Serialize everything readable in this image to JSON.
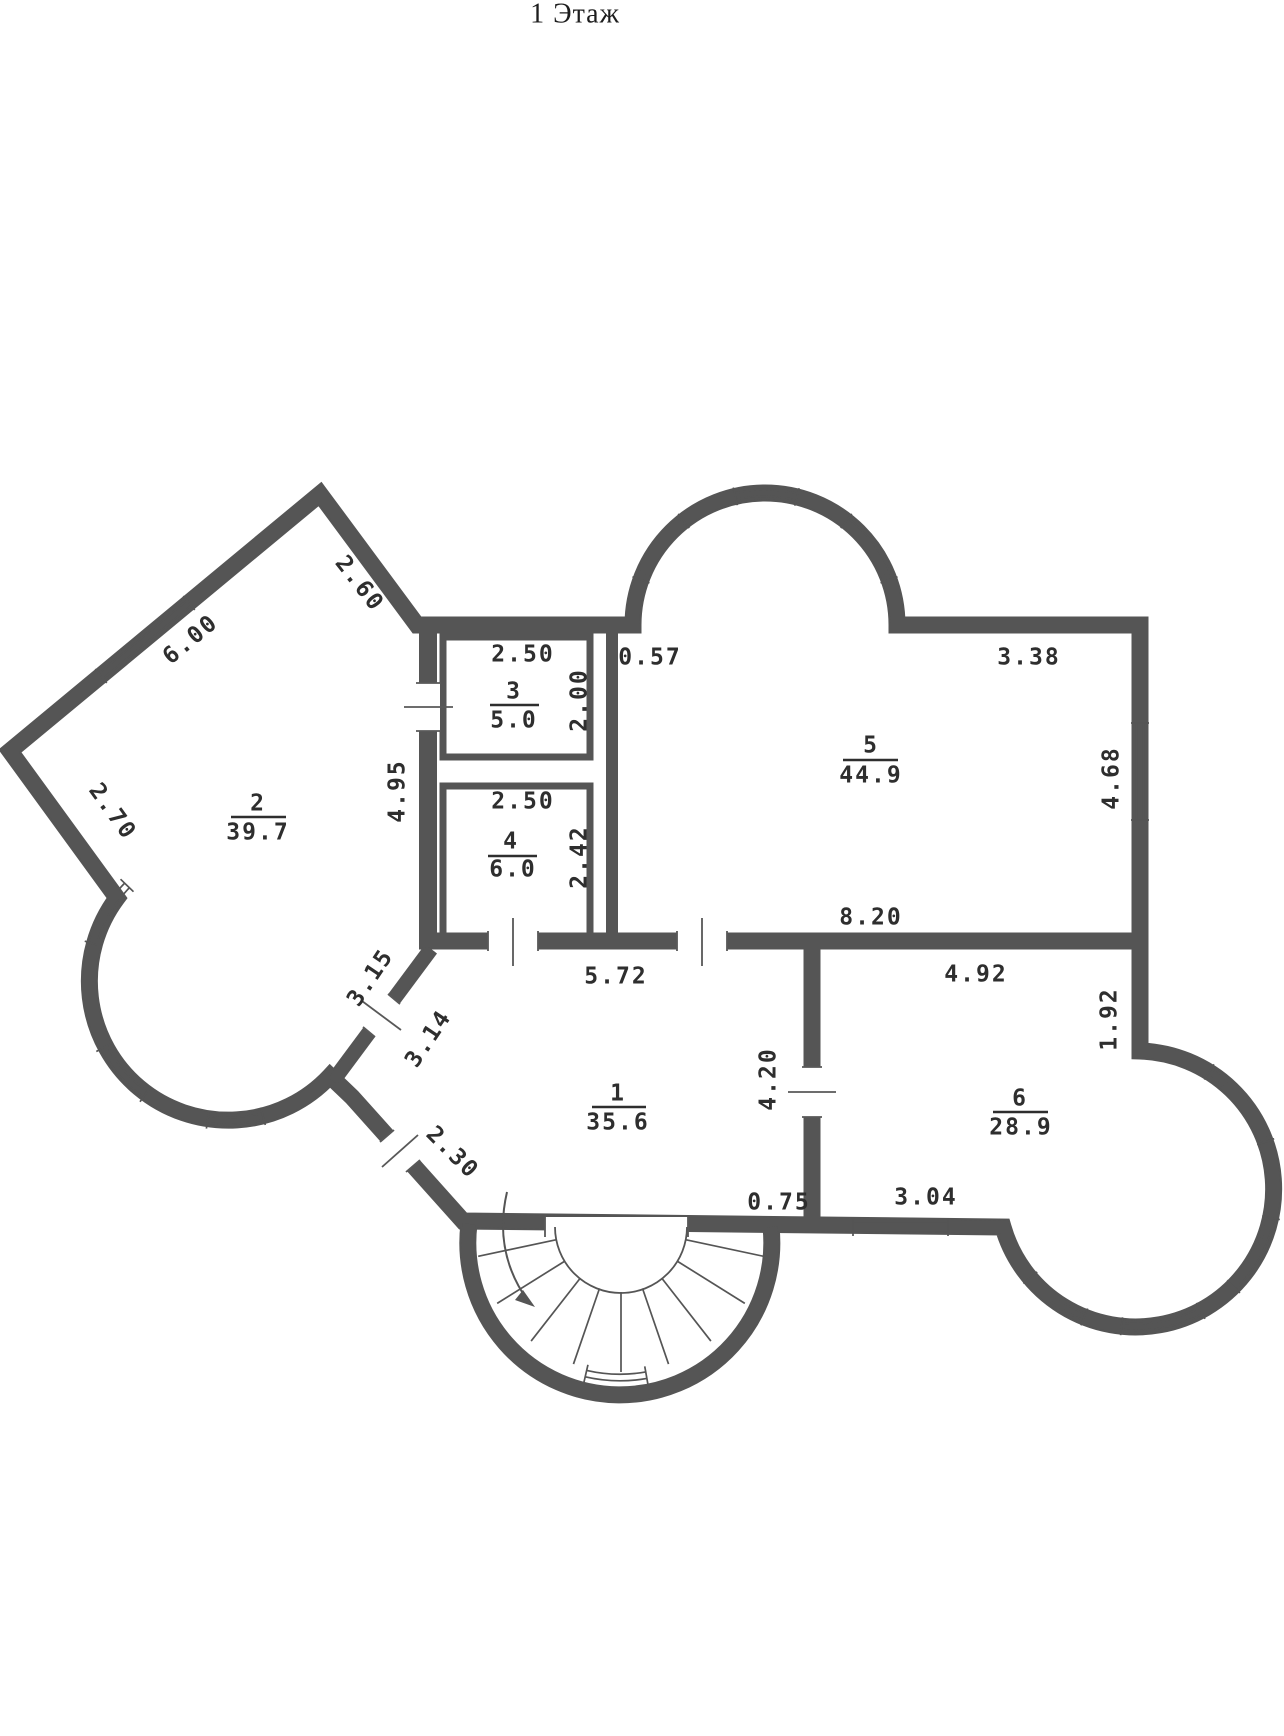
{
  "title": "1 Этаж",
  "floor_plan": {
    "rooms": [
      {
        "number": "1",
        "area": "35.6"
      },
      {
        "number": "2",
        "area": "39.7"
      },
      {
        "number": "3",
        "area": "5.0"
      },
      {
        "number": "4",
        "area": "6.0"
      },
      {
        "number": "5",
        "area": "44.9"
      },
      {
        "number": "6",
        "area": "28.9"
      }
    ],
    "dimensions": {
      "top_left_wall": "2.60",
      "upper_left_wall": "6.00",
      "left_wall": "2.70",
      "room2_right_wall": "4.95",
      "room3_width": "2.50",
      "room3_height": "2.00",
      "room5_top_left": "0.57",
      "room5_top_right": "3.38",
      "room5_right_wall": "4.68",
      "room4_width": "2.50",
      "room4_height": "2.42",
      "room5_bottom": "8.20",
      "room1_top": "5.72",
      "room6_top": "4.92",
      "room6_right_wall": "1.92",
      "room1_room6_wall": "4.20",
      "room1_left_upper": "3.15",
      "room1_left_lower": "3.14",
      "room1_bottom_left": "2.30",
      "room1_bottom_right": "0.75",
      "room6_bottom": "3.04"
    }
  }
}
